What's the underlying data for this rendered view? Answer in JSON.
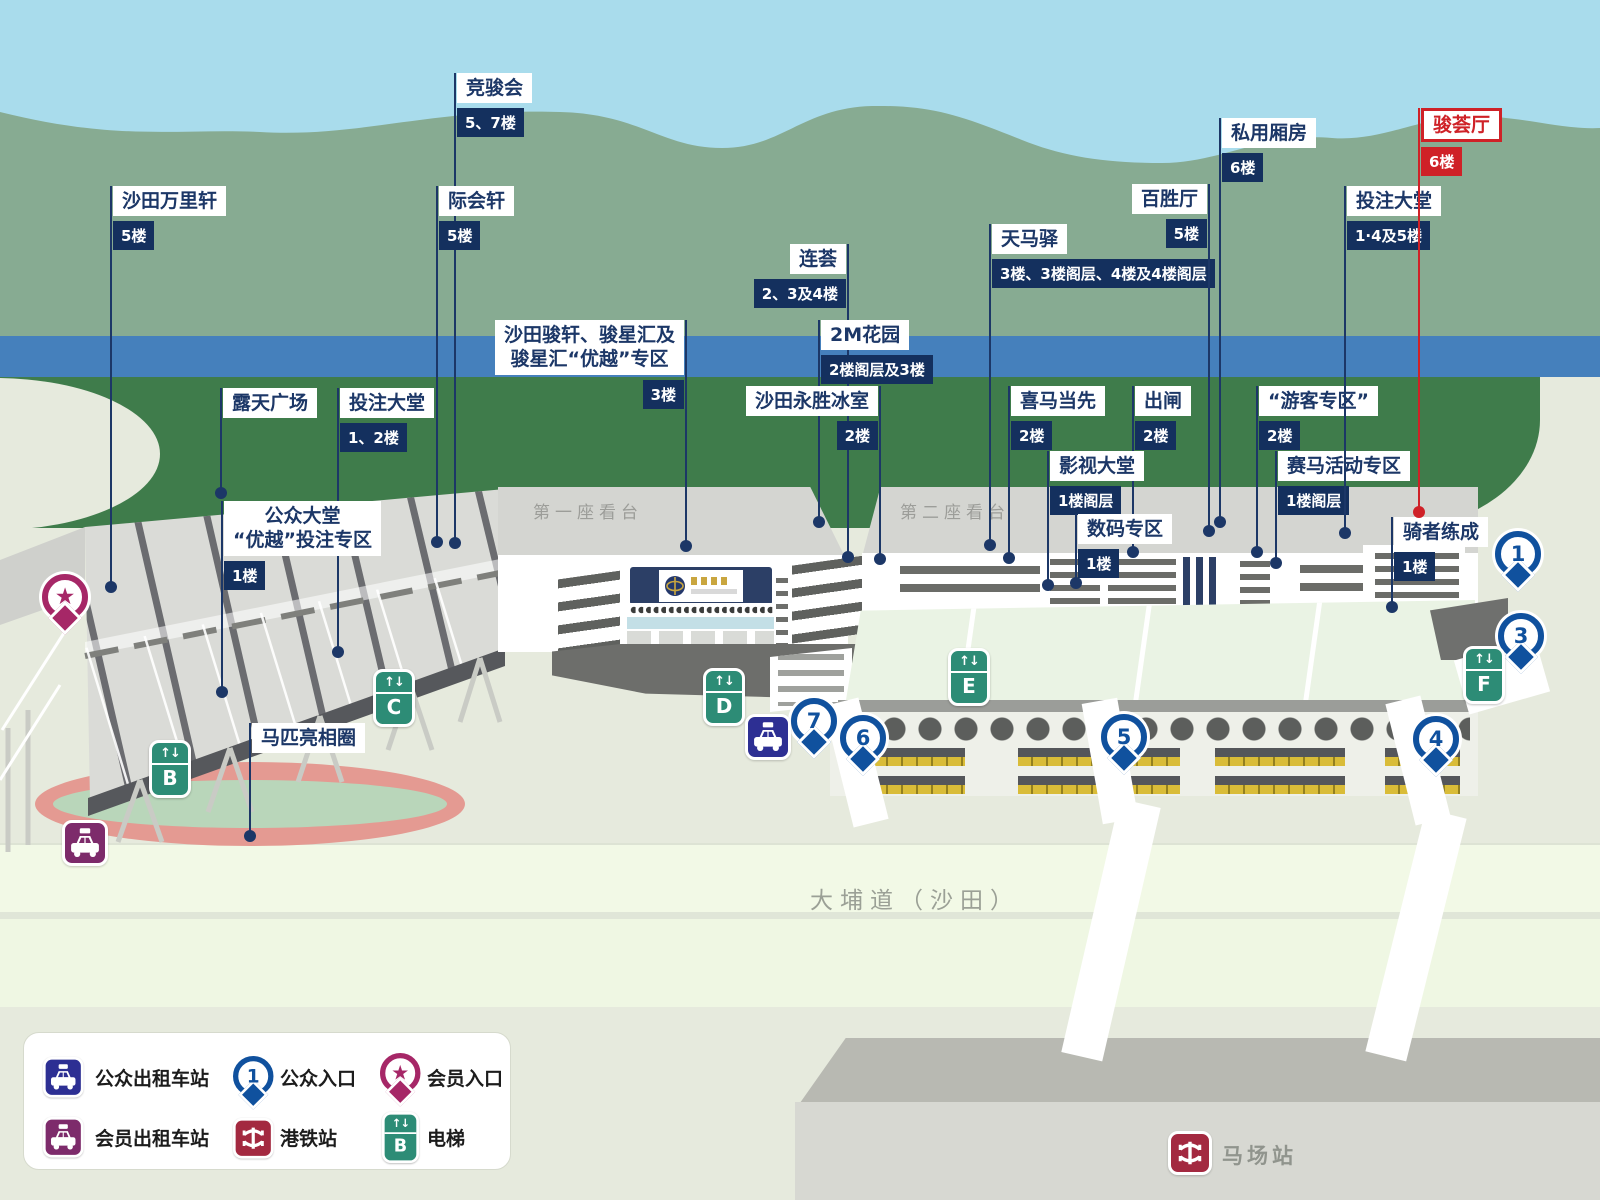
{
  "map_texts": {
    "grandstand1": "第一座看台",
    "grandstand2": "第二座看台",
    "road": "大埔道（沙田）",
    "station": "马场站"
  },
  "highlighted_facility": "骏荟厅",
  "facility_labels": [
    {
      "name": "沙田万里轩",
      "floor": "5楼",
      "x": 111,
      "top": 186,
      "dot_y": 587,
      "side": "L"
    },
    {
      "name": "竞骏会",
      "floor": "5、7楼",
      "x": 455,
      "top": 73,
      "dot_y": 543,
      "side": "L"
    },
    {
      "name": "际会轩",
      "floor": "5楼",
      "x": 437,
      "top": 186,
      "dot_y": 542,
      "side": "L"
    },
    {
      "name": "露天广场",
      "floor": null,
      "x": 221,
      "top": 388,
      "dot_y": 493,
      "side": "L"
    },
    {
      "name": "投注大堂",
      "floor": "1、2楼",
      "x": 338,
      "top": 388,
      "dot_y": 652,
      "side": "L"
    },
    {
      "name": "公众大堂\n“优越”投注专区",
      "floor": "1楼",
      "x": 222,
      "top": 501,
      "dot_y": 692,
      "side": "L"
    },
    {
      "name": "马匹亮相圈",
      "floor": null,
      "x": 250,
      "top": 723,
      "dot_y": 836,
      "side": "L"
    },
    {
      "name": "沙田骏轩、骏星汇及\n骏星汇“优越”专区",
      "floor": "3楼",
      "x": 686,
      "top": 320,
      "dot_y": 546,
      "side": "R"
    },
    {
      "name": "连荟",
      "floor": "2、3及4楼",
      "x": 848,
      "top": 244,
      "dot_y": 557,
      "side": "R"
    },
    {
      "name": "2M花园",
      "floor": "2楼阁层及3楼",
      "x": 819,
      "top": 320,
      "dot_y": 522,
      "side": "L"
    },
    {
      "name": "沙田永胜冰室",
      "floor": "2楼",
      "x": 880,
      "top": 386,
      "dot_y": 559,
      "side": "R"
    },
    {
      "name": "天马驿",
      "floor": "3楼、3楼阁层、4楼及4楼阁层",
      "x": 990,
      "top": 224,
      "dot_y": 545,
      "side": "L"
    },
    {
      "name": "喜马当先",
      "floor": "2楼",
      "x": 1009,
      "top": 386,
      "dot_y": 558,
      "side": "L"
    },
    {
      "name": "出闸",
      "floor": "2楼",
      "x": 1133,
      "top": 386,
      "dot_y": 552,
      "side": "L"
    },
    {
      "name": "影视大堂",
      "floor": "1楼阁层",
      "x": 1048,
      "top": 451,
      "dot_y": 585,
      "side": "L"
    },
    {
      "name": "数码专区",
      "floor": "1楼",
      "x": 1076,
      "top": 514,
      "dot_y": 583,
      "side": "L"
    },
    {
      "name": "“游客专区”",
      "floor": "2楼",
      "x": 1257,
      "top": 386,
      "dot_y": 552,
      "side": "L"
    },
    {
      "name": "赛马活动专区",
      "floor": "1楼阁层",
      "x": 1276,
      "top": 451,
      "dot_y": 563,
      "side": "L"
    },
    {
      "name": "百胜厅",
      "floor": "5楼",
      "x": 1209,
      "top": 184,
      "dot_y": 531,
      "side": "R"
    },
    {
      "name": "私用厢房",
      "floor": "6楼",
      "x": 1220,
      "top": 118,
      "dot_y": 522,
      "side": "L"
    },
    {
      "name": "投注大堂",
      "floor": "1·4及5楼",
      "x": 1345,
      "top": 186,
      "dot_y": 533,
      "side": "L"
    },
    {
      "name": "骑者练成",
      "floor": "1楼",
      "x": 1392,
      "top": 517,
      "dot_y": 607,
      "side": "L"
    },
    {
      "name": "骏荟厅",
      "floor": "6楼",
      "x": 1419,
      "top": 108,
      "dot_y": 512,
      "side": "L",
      "red": true
    }
  ],
  "entrance_pins": [
    {
      "num": "1",
      "x": 1518,
      "y": 554
    },
    {
      "num": "3",
      "x": 1521,
      "y": 636
    },
    {
      "num": "4",
      "x": 1436,
      "y": 739
    },
    {
      "num": "5",
      "x": 1124,
      "y": 737
    },
    {
      "num": "6",
      "x": 863,
      "y": 738
    },
    {
      "num": "7",
      "x": 814,
      "y": 721
    }
  ],
  "lifts": [
    {
      "letter": "B",
      "x": 170,
      "y": 769
    },
    {
      "letter": "C",
      "x": 394,
      "y": 698
    },
    {
      "letter": "D",
      "x": 724,
      "y": 697
    },
    {
      "letter": "E",
      "x": 969,
      "y": 677
    },
    {
      "letter": "F",
      "x": 1484,
      "y": 675
    }
  ],
  "taxi_stands": [
    {
      "type": "public",
      "x": 768,
      "y": 737
    },
    {
      "type": "member",
      "x": 85,
      "y": 843
    }
  ],
  "member_entrance_pin": {
    "x": 65,
    "y": 597
  },
  "legend": {
    "items": [
      {
        "icon": "taxi-public",
        "label": "公众出租车站",
        "ix": 43,
        "iy": 1057,
        "lx": 95,
        "ly": 1064
      },
      {
        "icon": "entrance-pin",
        "pin_num": "1",
        "label": "公众入口",
        "ix": 233,
        "iy": 1056,
        "lx": 280,
        "ly": 1064
      },
      {
        "icon": "member-pin",
        "label": "会员入口",
        "ix": 380,
        "iy": 1053,
        "lx": 427,
        "ly": 1064
      },
      {
        "icon": "taxi-member",
        "label": "会员出租车站",
        "ix": 43,
        "iy": 1117,
        "lx": 95,
        "ly": 1124
      },
      {
        "icon": "mtr",
        "label": "港铁站",
        "ix": 233,
        "iy": 1118,
        "lx": 280,
        "ly": 1124
      },
      {
        "icon": "lift",
        "lift_letter": "B",
        "label": "电梯",
        "ix": 382,
        "iy": 1112,
        "lx": 427,
        "ly": 1124
      }
    ]
  },
  "colors": {
    "navy": "#1c3767",
    "tag_navy": "#14305e",
    "red": "#cf2127",
    "pin_blue": "#10519e",
    "lift_green": "#2d8c76",
    "taxi_public": "#2d2f93",
    "taxi_member": "#7d2b6b",
    "member_pin": "#a62767",
    "mtr_red": "#a32940",
    "field_green": "#3f7c4b",
    "river_blue": "#4580bc"
  }
}
